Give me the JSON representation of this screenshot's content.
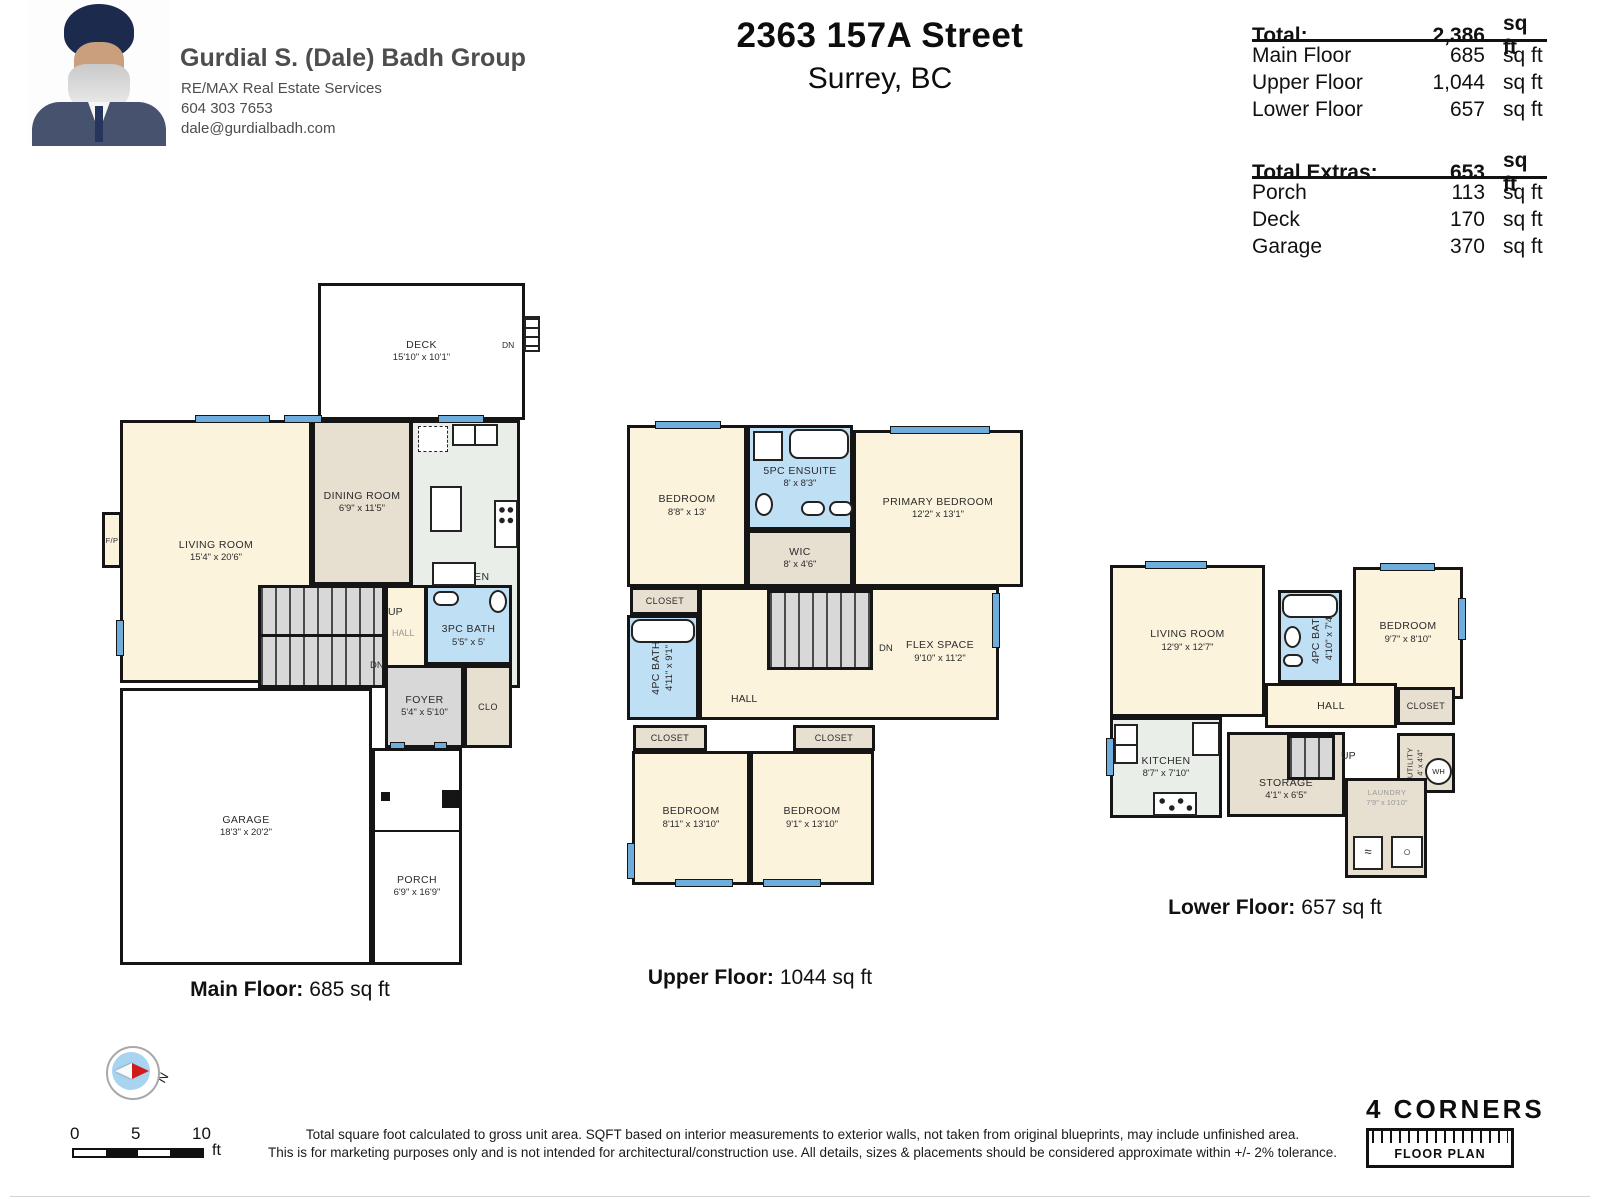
{
  "header": {
    "agent_name": "Gurdial S. (Dale) Badh Group",
    "agent_company": "RE/MAX Real Estate Services",
    "agent_phone": "604 303 7653",
    "agent_email": "dale@gurdialbadh.com",
    "address_line1": "2363 157A Street",
    "address_line2": "Surrey, BC"
  },
  "summary": {
    "total": {
      "label": "Total:",
      "value": "2,386",
      "unit": "sq ft"
    },
    "floors": [
      {
        "label": "Main Floor",
        "value": "685",
        "unit": "sq ft"
      },
      {
        "label": "Upper Floor",
        "value": "1,044",
        "unit": "sq ft"
      },
      {
        "label": "Lower Floor",
        "value": "657",
        "unit": "sq ft"
      }
    ],
    "extras_total": {
      "label": "Total Extras:",
      "value": "653",
      "unit": "sq ft"
    },
    "extras": [
      {
        "label": "Porch",
        "value": "113",
        "unit": "sq ft"
      },
      {
        "label": "Deck",
        "value": "170",
        "unit": "sq ft"
      },
      {
        "label": "Garage",
        "value": "370",
        "unit": "sq ft"
      }
    ]
  },
  "colors": {
    "wall": "#151515",
    "window": "#6FAEDC",
    "room_cream": "#FBF3DC",
    "closet_tan": "#E7DFD0",
    "bath_blue": "#BFDFF4",
    "kitchen_green": "#E9EFE8",
    "stairs_gray": "#D8D8D8"
  },
  "plans": {
    "main": {
      "caption": {
        "label": "Main Floor:",
        "value": "685 sq ft"
      },
      "deck": {
        "name": "DECK",
        "dims": "15'10\" x 10'1\""
      },
      "deck_dn": "DN",
      "living": {
        "name": "LIVING ROOM",
        "dims": "15'4\" x 20'6\""
      },
      "fp": "F/P",
      "dining": {
        "name": "DINING ROOM",
        "dims": "6'9\" x 11'5\""
      },
      "kitchen": {
        "name": "KITCHEN",
        "dims": "9' x 13'"
      },
      "up": "UP",
      "hall": "HALL",
      "dn": "DN",
      "bath": {
        "name": "3PC BATH",
        "dims": "5'5\" x 5'"
      },
      "foyer": {
        "name": "FOYER",
        "dims": "5'4\" x 5'10\""
      },
      "closet": "CLO",
      "garage": {
        "name": "GARAGE",
        "dims": "18'3\" x 20'2\""
      },
      "porch": {
        "name": "PORCH",
        "dims": "6'9\" x 16'9\""
      }
    },
    "upper": {
      "caption": {
        "label": "Upper Floor:",
        "value": "1044 sq ft"
      },
      "bedroom1": {
        "name": "BEDROOM",
        "dims": "8'8\" x 13'"
      },
      "ensuite": {
        "name": "5PC ENSUITE",
        "dims": "8' x 8'3\""
      },
      "primary": {
        "name": "PRIMARY BEDROOM",
        "dims": "12'2\" x 13'1\""
      },
      "wic": {
        "name": "WIC",
        "dims": "8' x 4'6\""
      },
      "closet_left": "CLOSET",
      "bath": {
        "name": "4PC BATH",
        "dims": "4'11\" x 9'1\""
      },
      "dn": "DN",
      "flex": {
        "name": "FLEX SPACE",
        "dims": "9'10\" x 11'2\""
      },
      "hall": "HALL",
      "closet_a": "CLOSET",
      "closet_b": "CLOSET",
      "bedroom2": {
        "name": "BEDROOM",
        "dims": "8'11\" x 13'10\""
      },
      "bedroom3": {
        "name": "BEDROOM",
        "dims": "9'1\" x 13'10\""
      }
    },
    "lower": {
      "caption": {
        "label": "Lower Floor:",
        "value": "657 sq ft"
      },
      "living": {
        "name": "LIVING ROOM",
        "dims": "12'9\" x 12'7\""
      },
      "bath": {
        "name": "4PC BATH",
        "dims": "4'10\" x 7'4\""
      },
      "bedroom": {
        "name": "BEDROOM",
        "dims": "9'7\" x 8'10\""
      },
      "hall": "HALL",
      "closet": "CLOSET",
      "kitchen": {
        "name": "KITCHEN",
        "dims": "8'7\" x 7'10\""
      },
      "storage": {
        "name": "STORAGE",
        "dims": "4'1\" x 6'5\""
      },
      "up": "UP",
      "utility": {
        "name": "UTILITY",
        "dims": "4' x 4'4\""
      },
      "wh": "WH",
      "laundry": {
        "name": "LAUNDRY",
        "dims": "7'9\" x 10'10\""
      }
    }
  },
  "footer": {
    "compass_n": "N",
    "scale": {
      "t0": "0",
      "t1": "5",
      "t2": "10",
      "unit": "ft"
    },
    "disclaimer_line1": "Total square foot calculated to gross unit area. SQFT based on interior measurements to exterior walls, not taken from original blueprints, may include unfinished area.",
    "disclaimer_line2": "This is for marketing purposes only and is not intended for architectural/construction use.  All details, sizes & placements should be considered approximate within +/- 2%  tolerance.",
    "logo_title": "4 CORNERS",
    "logo_subtitle": "FLOOR PLAN"
  }
}
